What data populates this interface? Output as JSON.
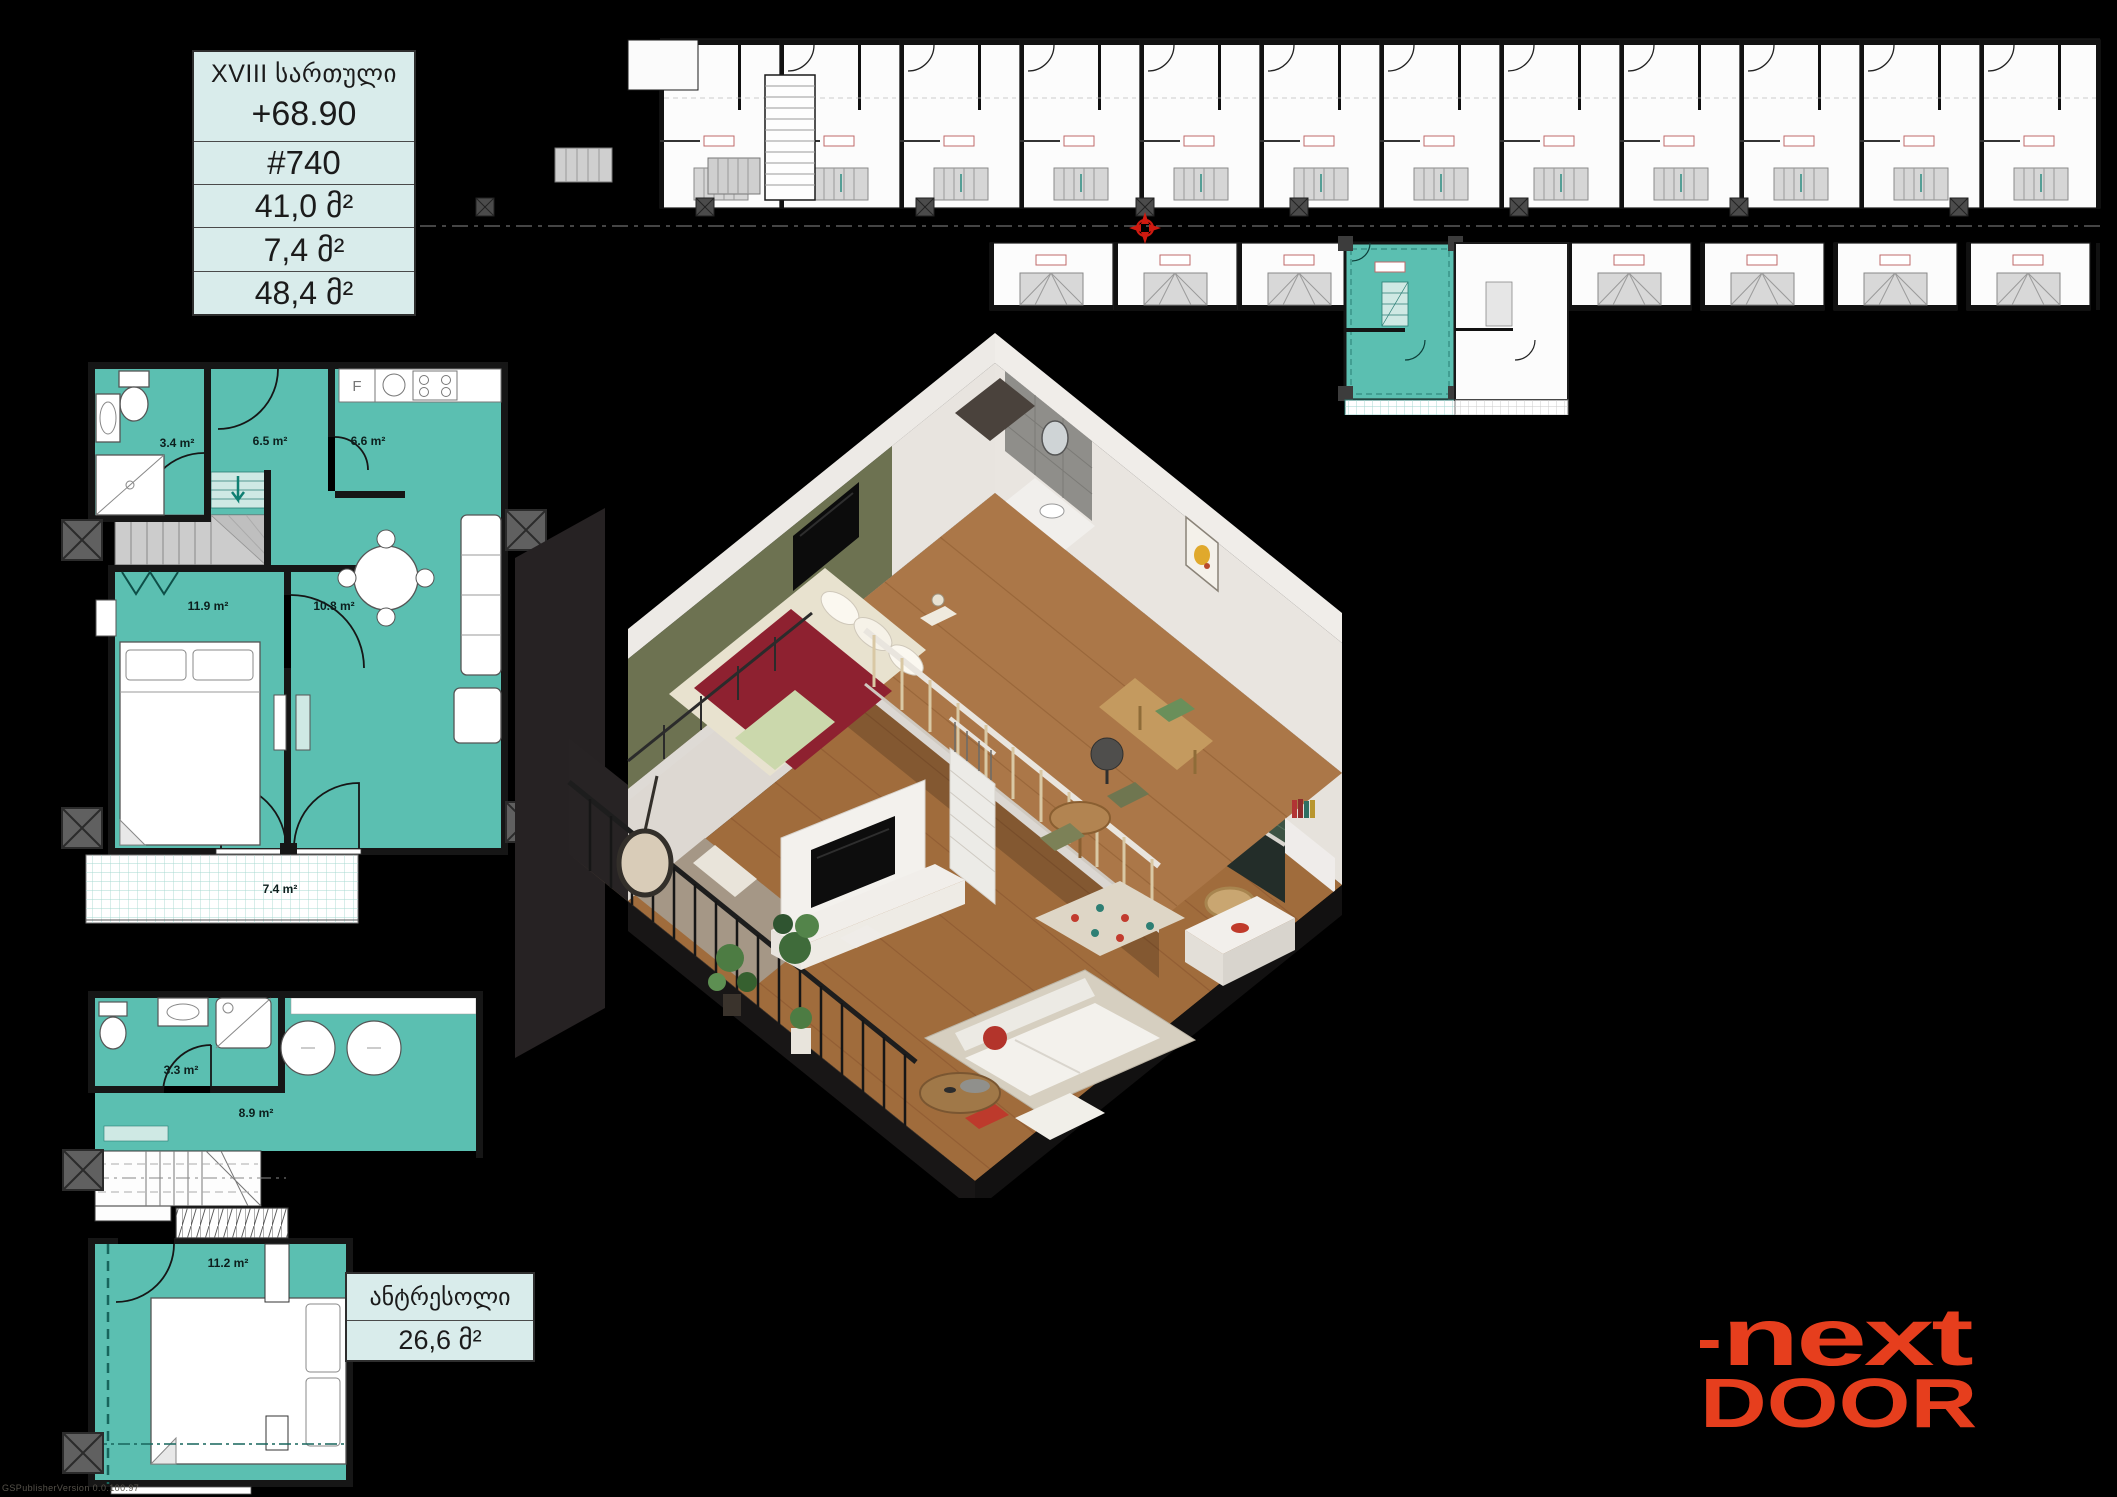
{
  "info_table": {
    "floor": "XVIII სართული",
    "elevation": "+68.90",
    "unit": "#740",
    "living_area": "41,0 მ²",
    "balcony_area": "7,4 მ²",
    "total_area": "48,4 მ²"
  },
  "overview_plan": {
    "description": "building floor overview with highlighted unit",
    "highlight_color": "#5bbfb1"
  },
  "main_plan": {
    "rooms": {
      "bathroom": "3.4 m²",
      "hall": "6.5 m²",
      "kitchen": "6.6 m²",
      "bedroom": "11.9 m²",
      "living": "10.8 m²",
      "balcony": "7.4 m²"
    },
    "fridge": "F"
  },
  "antresol_plan": {
    "rooms": {
      "bathroom": "3.3 m²",
      "hall": "8.9 m²",
      "bedroom": "11.2 m²"
    }
  },
  "antresol_label": {
    "title": "ანტრესოლი",
    "area": "26,6 მ²"
  },
  "brand": {
    "line1": "next",
    "line2": "DOOR"
  },
  "watermark": "GSPublisherVersion 0.0.100.97",
  "colors": {
    "teal": "#5bbfb1",
    "teal_light": "#cfe9e4",
    "table_bg": "#d9eceb",
    "logo": "#e63e1d"
  }
}
